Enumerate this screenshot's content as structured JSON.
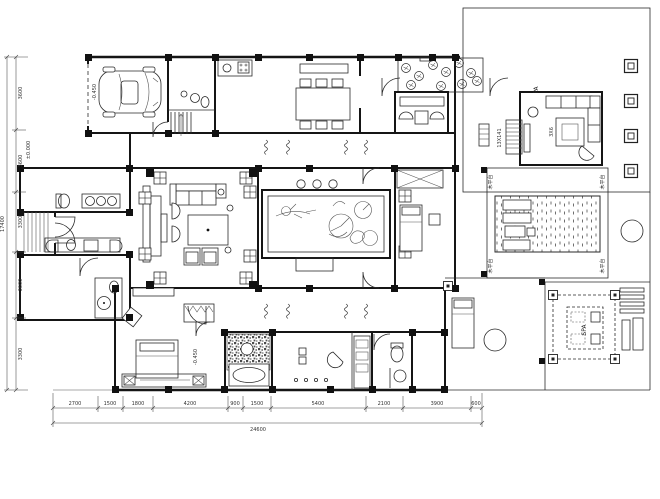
{
  "drawing": {
    "type": "architectural-floor-plan",
    "line_color": "#151515",
    "background": "#ffffff"
  },
  "dims_bottom": {
    "segments": [
      "2700",
      "1500",
      "1800",
      "4200",
      "900",
      "1500",
      "5400",
      "2100",
      "3900",
      "600"
    ],
    "total": "24600"
  },
  "dims_left": {
    "segments": [
      "3600",
      "3600",
      "3300",
      "3600",
      "3300"
    ],
    "total": "17400"
  },
  "labels": {
    "pa": "PA",
    "spa": "SPA",
    "rug": "3X6",
    "stair_note": "13X141",
    "deck_left": "木平台",
    "deck_right": "木平台",
    "elev_garage": "-0.450",
    "elev_entry": "±0.000",
    "elev_bath": "-0.450"
  }
}
